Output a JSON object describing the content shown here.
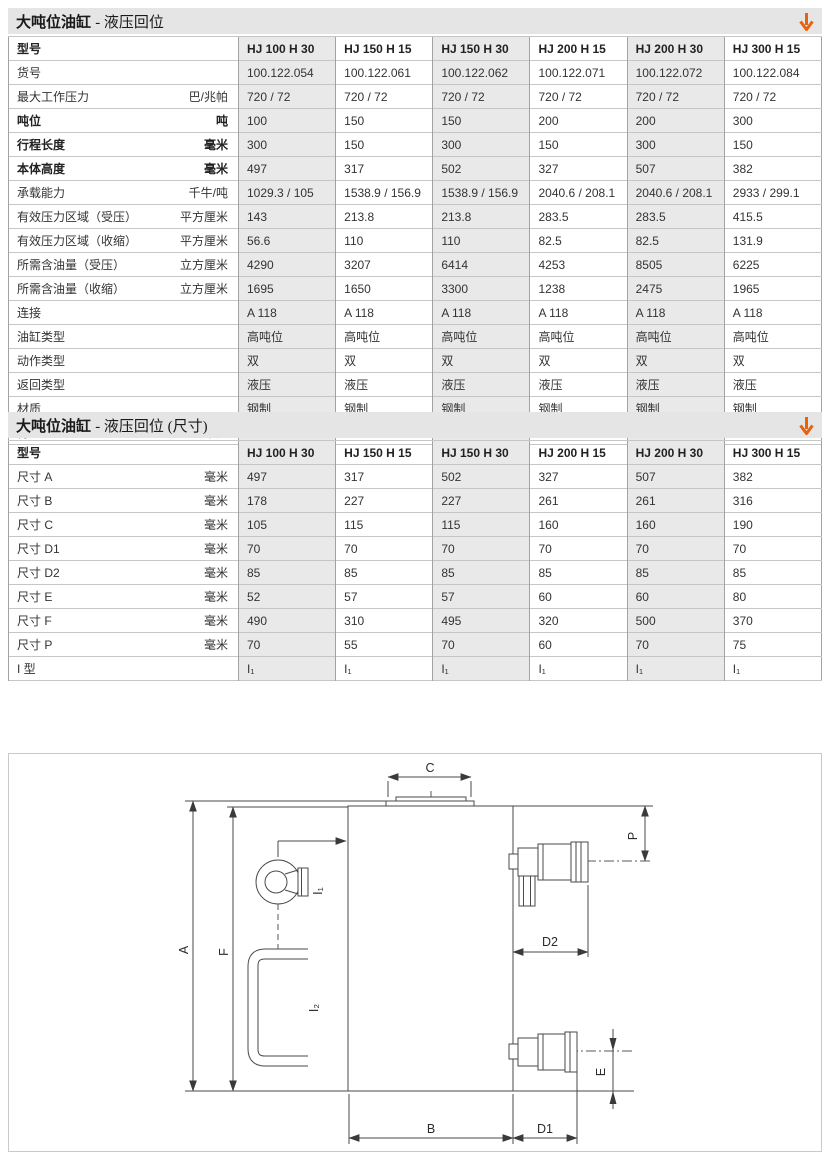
{
  "colors": {
    "accent_orange": "#e8610c",
    "table_shade": "#e9e9e9",
    "diagram_line": "#4a4a4a"
  },
  "table1": {
    "title_main": "大吨位油缸",
    "title_sub": "- 液压回位",
    "header": {
      "label": "型号",
      "models": [
        "HJ 100 H 30",
        "HJ 150 H 15",
        "HJ 150 H 30",
        "HJ 200 H 15",
        "HJ 200 H 30",
        "HJ 300 H 15"
      ]
    },
    "rows": [
      {
        "label": "货号",
        "unit": "",
        "bold": false,
        "values": [
          "100.122.054",
          "100.122.061",
          "100.122.062",
          "100.122.071",
          "100.122.072",
          "100.122.084"
        ]
      },
      {
        "label": "最大工作压力",
        "unit": "巴/兆帕",
        "bold": false,
        "values": [
          "720 / 72",
          "720 / 72",
          "720 / 72",
          "720 / 72",
          "720 / 72",
          "720 / 72"
        ]
      },
      {
        "label": "吨位",
        "unit": "吨",
        "bold": true,
        "values": [
          "100",
          "150",
          "150",
          "200",
          "200",
          "300"
        ]
      },
      {
        "label": "行程长度",
        "unit": "毫米",
        "bold": true,
        "values": [
          "300",
          "150",
          "300",
          "150",
          "300",
          "150"
        ]
      },
      {
        "label": "本体高度",
        "unit": "毫米",
        "bold": true,
        "values": [
          "497",
          "317",
          "502",
          "327",
          "507",
          "382"
        ]
      },
      {
        "label": "承载能力",
        "unit": "千牛/吨",
        "bold": false,
        "values": [
          "1029.3 / 105",
          "1538.9 / 156.9",
          "1538.9 / 156.9",
          "2040.6 / 208.1",
          "2040.6 / 208.1",
          "2933 / 299.1"
        ]
      },
      {
        "label": "有效压力区域（受压）",
        "unit": "平方厘米",
        "bold": false,
        "values": [
          "143",
          "213.8",
          "213.8",
          "283.5",
          "283.5",
          "415.5"
        ]
      },
      {
        "label": "有效压力区域（收缩）",
        "unit": "平方厘米",
        "bold": false,
        "values": [
          "56.6",
          "110",
          "110",
          "82.5",
          "82.5",
          "131.9"
        ]
      },
      {
        "label": "所需含油量（受压）",
        "unit": "立方厘米",
        "bold": false,
        "values": [
          "4290",
          "3207",
          "6414",
          "4253",
          "8505",
          "6225"
        ]
      },
      {
        "label": "所需含油量（收缩）",
        "unit": "立方厘米",
        "bold": false,
        "values": [
          "1695",
          "1650",
          "3300",
          "1238",
          "2475",
          "1965"
        ]
      },
      {
        "label": "连接",
        "unit": "",
        "bold": false,
        "values": [
          "A 118",
          "A 118",
          "A 118",
          "A 118",
          "A 118",
          "A 118"
        ]
      },
      {
        "label": "油缸类型",
        "unit": "",
        "bold": false,
        "values": [
          "高吨位",
          "高吨位",
          "高吨位",
          "高吨位",
          "高吨位",
          "高吨位"
        ]
      },
      {
        "label": "动作类型",
        "unit": "",
        "bold": false,
        "values": [
          "双",
          "双",
          "双",
          "双",
          "双",
          "双"
        ]
      },
      {
        "label": "返回类型",
        "unit": "",
        "bold": false,
        "values": [
          "液压",
          "液压",
          "液压",
          "液压",
          "液压",
          "液压"
        ]
      },
      {
        "label": "材质",
        "unit": "",
        "bold": false,
        "values": [
          "钢制",
          "钢制",
          "钢制",
          "钢制",
          "钢制",
          "钢制"
        ]
      },
      {
        "label": "待用重量",
        "unit": "千克",
        "bold": false,
        "values": [
          "85",
          "76",
          "128",
          "121",
          "186",
          "240"
        ]
      }
    ]
  },
  "table2": {
    "title_main": "大吨位油缸",
    "title_sub": "- 液压回位 (尺寸)",
    "header": {
      "label": "型号",
      "models": [
        "HJ 100 H 30",
        "HJ 150 H 15",
        "HJ 150 H 30",
        "HJ 200 H 15",
        "HJ 200 H 30",
        "HJ 300 H 15"
      ]
    },
    "rows": [
      {
        "label": "尺寸 A",
        "unit": "毫米",
        "bold": false,
        "values": [
          "497",
          "317",
          "502",
          "327",
          "507",
          "382"
        ]
      },
      {
        "label": "尺寸 B",
        "unit": "毫米",
        "bold": false,
        "values": [
          "178",
          "227",
          "227",
          "261",
          "261",
          "316"
        ]
      },
      {
        "label": "尺寸 C",
        "unit": "毫米",
        "bold": false,
        "values": [
          "105",
          "115",
          "115",
          "160",
          "160",
          "190"
        ]
      },
      {
        "label": "尺寸 D1",
        "unit": "毫米",
        "bold": false,
        "values": [
          "70",
          "70",
          "70",
          "70",
          "70",
          "70"
        ]
      },
      {
        "label": "尺寸 D2",
        "unit": "毫米",
        "bold": false,
        "values": [
          "85",
          "85",
          "85",
          "85",
          "85",
          "85"
        ]
      },
      {
        "label": "尺寸 E",
        "unit": "毫米",
        "bold": false,
        "values": [
          "52",
          "57",
          "57",
          "60",
          "60",
          "80"
        ]
      },
      {
        "label": "尺寸 F",
        "unit": "毫米",
        "bold": false,
        "values": [
          "490",
          "310",
          "495",
          "320",
          "500",
          "370"
        ]
      },
      {
        "label": "尺寸 P",
        "unit": "毫米",
        "bold": false,
        "values": [
          "70",
          "55",
          "70",
          "60",
          "70",
          "75"
        ]
      },
      {
        "label": "I 型",
        "unit": "",
        "bold": false,
        "values": [
          "I₁",
          "I₁",
          "I₁",
          "I₁",
          "I₁",
          "I₁"
        ]
      }
    ]
  },
  "diagram": {
    "dim_a": "A",
    "dim_b": "B",
    "dim_c": "C",
    "dim_d1": "D1",
    "dim_d2": "D2",
    "dim_e": "E",
    "dim_f": "F",
    "dim_p": "P",
    "port_i1": "I₁",
    "port_i2": "I₂"
  }
}
